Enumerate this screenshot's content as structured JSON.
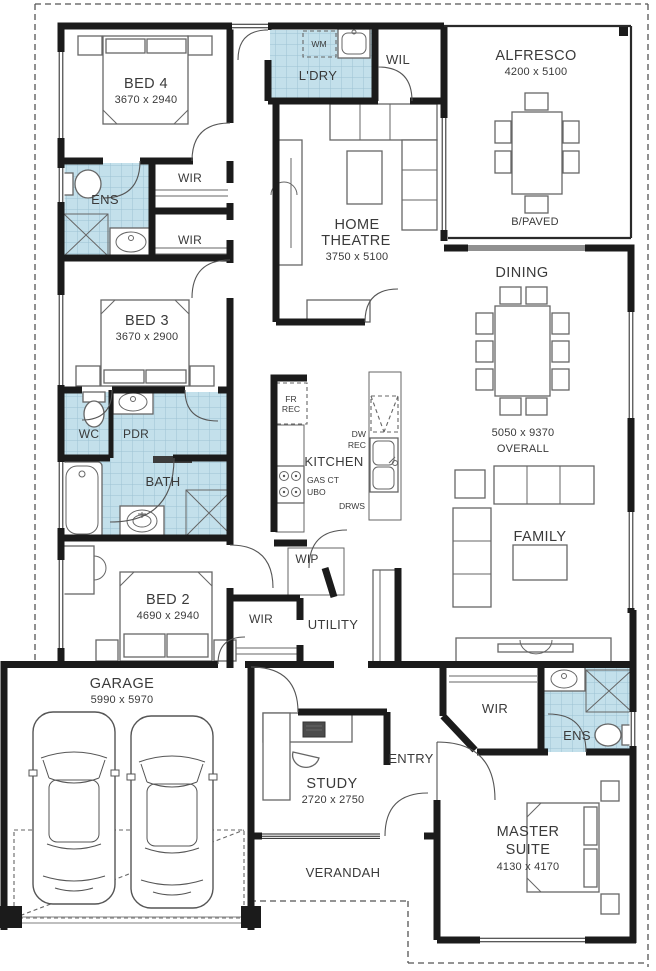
{
  "rooms": {
    "bed4": {
      "name": "BED 4",
      "dims": "3670 x 2940"
    },
    "laundry": {
      "name": "L'DRY"
    },
    "wil": {
      "name": "WIL"
    },
    "alfresco": {
      "name": "ALFRESCO",
      "dims": "4200 x 5100",
      "note": "B/PAVED"
    },
    "ens_front": {
      "name": "ENS"
    },
    "wir_bed4_a": {
      "name": "WIR"
    },
    "wir_bed4_b": {
      "name": "WIR"
    },
    "home_theatre": {
      "name_line1": "HOME",
      "name_line2": "THEATRE",
      "dims": "3750 x 5100"
    },
    "dining": {
      "name": "DINING"
    },
    "living_overall": {
      "dims": "5050 x 9370",
      "label": "OVERALL"
    },
    "bed3": {
      "name": "BED 3",
      "dims": "3670 x 2900"
    },
    "wc": {
      "name": "WC"
    },
    "pdr": {
      "name": "PDR"
    },
    "kitchen": {
      "name": "KITCHEN"
    },
    "bath": {
      "name": "BATH"
    },
    "family": {
      "name": "FAMILY"
    },
    "bed2": {
      "name": "BED 2",
      "dims": "4690 x 2940"
    },
    "wip": {
      "name": "WIP"
    },
    "wir_hall": {
      "name": "WIR"
    },
    "utility": {
      "name": "UTILITY"
    },
    "garage": {
      "name": "GARAGE",
      "dims": "5990 x 5970"
    },
    "wir_master": {
      "name": "WIR"
    },
    "ens_master": {
      "name": "ENS"
    },
    "study": {
      "name": "STUDY",
      "dims": "2720 x 2750"
    },
    "entry": {
      "name": "ENTRY"
    },
    "master_suite": {
      "name_line1": "MASTER",
      "name_line2": "SUITE",
      "dims": "4130 x 4170"
    },
    "verandah": {
      "name": "VERANDAH"
    }
  },
  "fixtures": {
    "washing_machine": "WM",
    "fridge_recess_line1": "FR",
    "fridge_recess_line2": "REC",
    "dishwasher_recess_line1": "DW",
    "dishwasher_recess_line2": "REC",
    "gas_cooktop": "GAS CT",
    "under_bench_oven": "UBO",
    "drawers": "DRWS"
  },
  "colors": {
    "tile": "#c3e0eb",
    "tile_grid": "#9cc2d3",
    "wall": "#1b1b1b",
    "furniture_line": "#606060",
    "text": "#3a3a3a",
    "boundary": "#555555"
  }
}
